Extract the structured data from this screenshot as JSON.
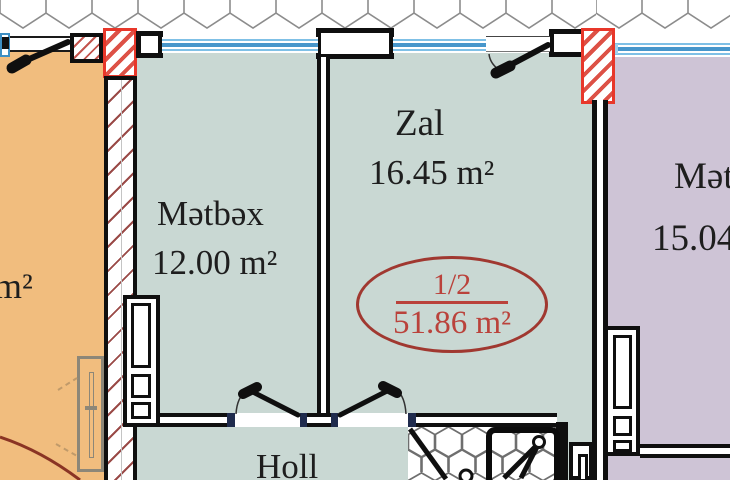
{
  "plan": {
    "stamp": {
      "fraction": "1/2",
      "total_area": "51.86 m²"
    },
    "rooms": {
      "kitchen": {
        "name": "Mətbəx",
        "area": "12.00 m²"
      },
      "living_room": {
        "name": "Zal",
        "area": "16.45 m²"
      },
      "hall": {
        "name": "Holl"
      },
      "adjacent_right": {
        "name": "Mət",
        "area": "15.04"
      },
      "adjacent_left": {
        "area_suffix": "m²"
      }
    },
    "colors": {
      "apartment_floor_teal": "#c9d8d3",
      "adjacent_left_floor_orange": "#f1bd7e",
      "adjacent_right_floor_purple": "#cec4d6",
      "window_glass_blue": "#4796cb",
      "structural_column_red": "#e8372a",
      "wall_hatch_maroon": "#9a4a47",
      "stamp_red": "#ba423b"
    }
  }
}
